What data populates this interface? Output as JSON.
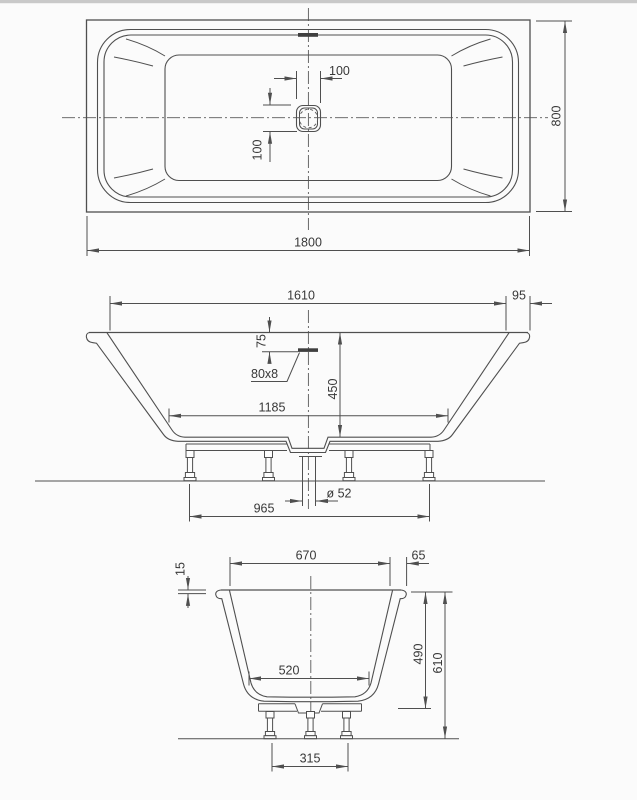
{
  "page": {
    "background": "#fbfbfb",
    "line_color": "#4f4f4f",
    "text_color": "#383838",
    "top_border_color": "#c9c9c9"
  },
  "views": {
    "plan": {
      "overall_length": "1800",
      "overall_width": "800",
      "drain_size_x": "100",
      "drain_size_y": "100"
    },
    "side": {
      "inner_length": "1610",
      "rim_width": "95",
      "overflow_drop": "75",
      "overflow_slot": "80x8",
      "depth": "450",
      "bottom_length": "1185",
      "drain_diameter": "ø 52",
      "feet_spacing": "965"
    },
    "end": {
      "inner_width": "670",
      "rim_width": "65",
      "rim_thickness": "15",
      "bottom_width": "520",
      "inner_height": "490",
      "total_height": "610",
      "feet_spacing": "315"
    }
  }
}
